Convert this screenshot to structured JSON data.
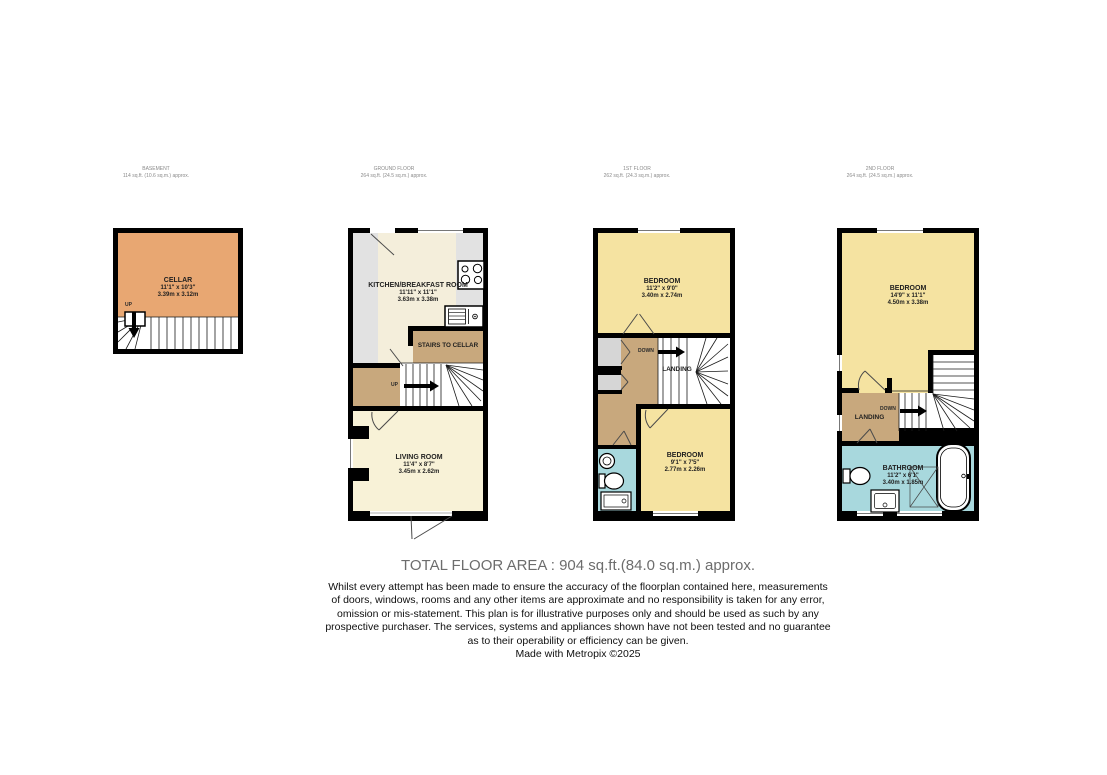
{
  "colors": {
    "wall": "#000000",
    "cellar": "#e8a772",
    "kitchen": "#f4eedb",
    "living": "#f8f2d7",
    "bedroom": "#f5e3a1",
    "bathroom": "#a8d8dd",
    "landing": "#c8a87d",
    "counter": "#e2e2e2",
    "closet": "#d6d6d6",
    "header_text": "#8a8a8a",
    "footer_title_text": "#6d6d6d"
  },
  "floor_headers": [
    {
      "name": "BASEMENT",
      "area": "114 sq.ft. (10.6 sq.m.) approx."
    },
    {
      "name": "GROUND FLOOR",
      "area": "264 sq.ft. (24.5 sq.m.) approx."
    },
    {
      "name": "1ST FLOOR",
      "area": "262 sq.ft. (24.3 sq.m.) approx."
    },
    {
      "name": "2ND FLOOR",
      "area": "264 sq.ft. (24.5 sq.m.) approx."
    }
  ],
  "basement": {
    "up": "UP",
    "cellar": {
      "name": "CELLAR",
      "dims_ft": "11'1\" x 10'3\"",
      "dims_m": "3.39m x 3.12m"
    }
  },
  "ground": {
    "up": "UP",
    "stairs_to_cellar": "STAIRS TO CELLAR",
    "kitchen": {
      "name": "KITCHEN/BREAKFAST ROOM",
      "dims_ft": "11'11\" x 11'1\"",
      "dims_m": "3.63m x 3.38m"
    },
    "living": {
      "name": "LIVING ROOM",
      "dims_ft": "11'4\" x 8'7\"",
      "dims_m": "3.45m x 2.62m"
    }
  },
  "first": {
    "down": "DOWN",
    "landing": "LANDING",
    "bedroom_front": {
      "name": "BEDROOM",
      "dims_ft": "11'2\" x 9'0\"",
      "dims_m": "3.40m x 2.74m"
    },
    "bedroom_back": {
      "name": "BEDROOM",
      "dims_ft": "9'1\" x 7'5\"",
      "dims_m": "2.77m x 2.26m"
    }
  },
  "second": {
    "down": "DOWN",
    "landing": "LANDING",
    "bedroom": {
      "name": "BEDROOM",
      "dims_ft": "14'9\" x 11'1\"",
      "dims_m": "4.50m x 3.38m"
    },
    "bathroom": {
      "name": "BATHROOM",
      "dims_ft": "11'2\" x 6'1\"",
      "dims_m": "3.40m x 1.85m"
    }
  },
  "footer": {
    "total_area": "TOTAL FLOOR AREA : 904 sq.ft.(84.0 sq.m.) approx.",
    "disclaimer_lines": [
      "Whilst every attempt has been made to ensure the accuracy of the floorplan contained here, measurements",
      "of doors, windows, rooms and any other items are approximate and no responsibility is taken for any error,",
      "omission or mis-statement. This plan is for illustrative purposes only and should be used as such by any",
      "prospective purchaser. The services, systems and appliances shown have not been tested and no guarantee",
      "as to their operability or efficiency can be given."
    ],
    "credit": "Made with Metropix ©2025"
  }
}
